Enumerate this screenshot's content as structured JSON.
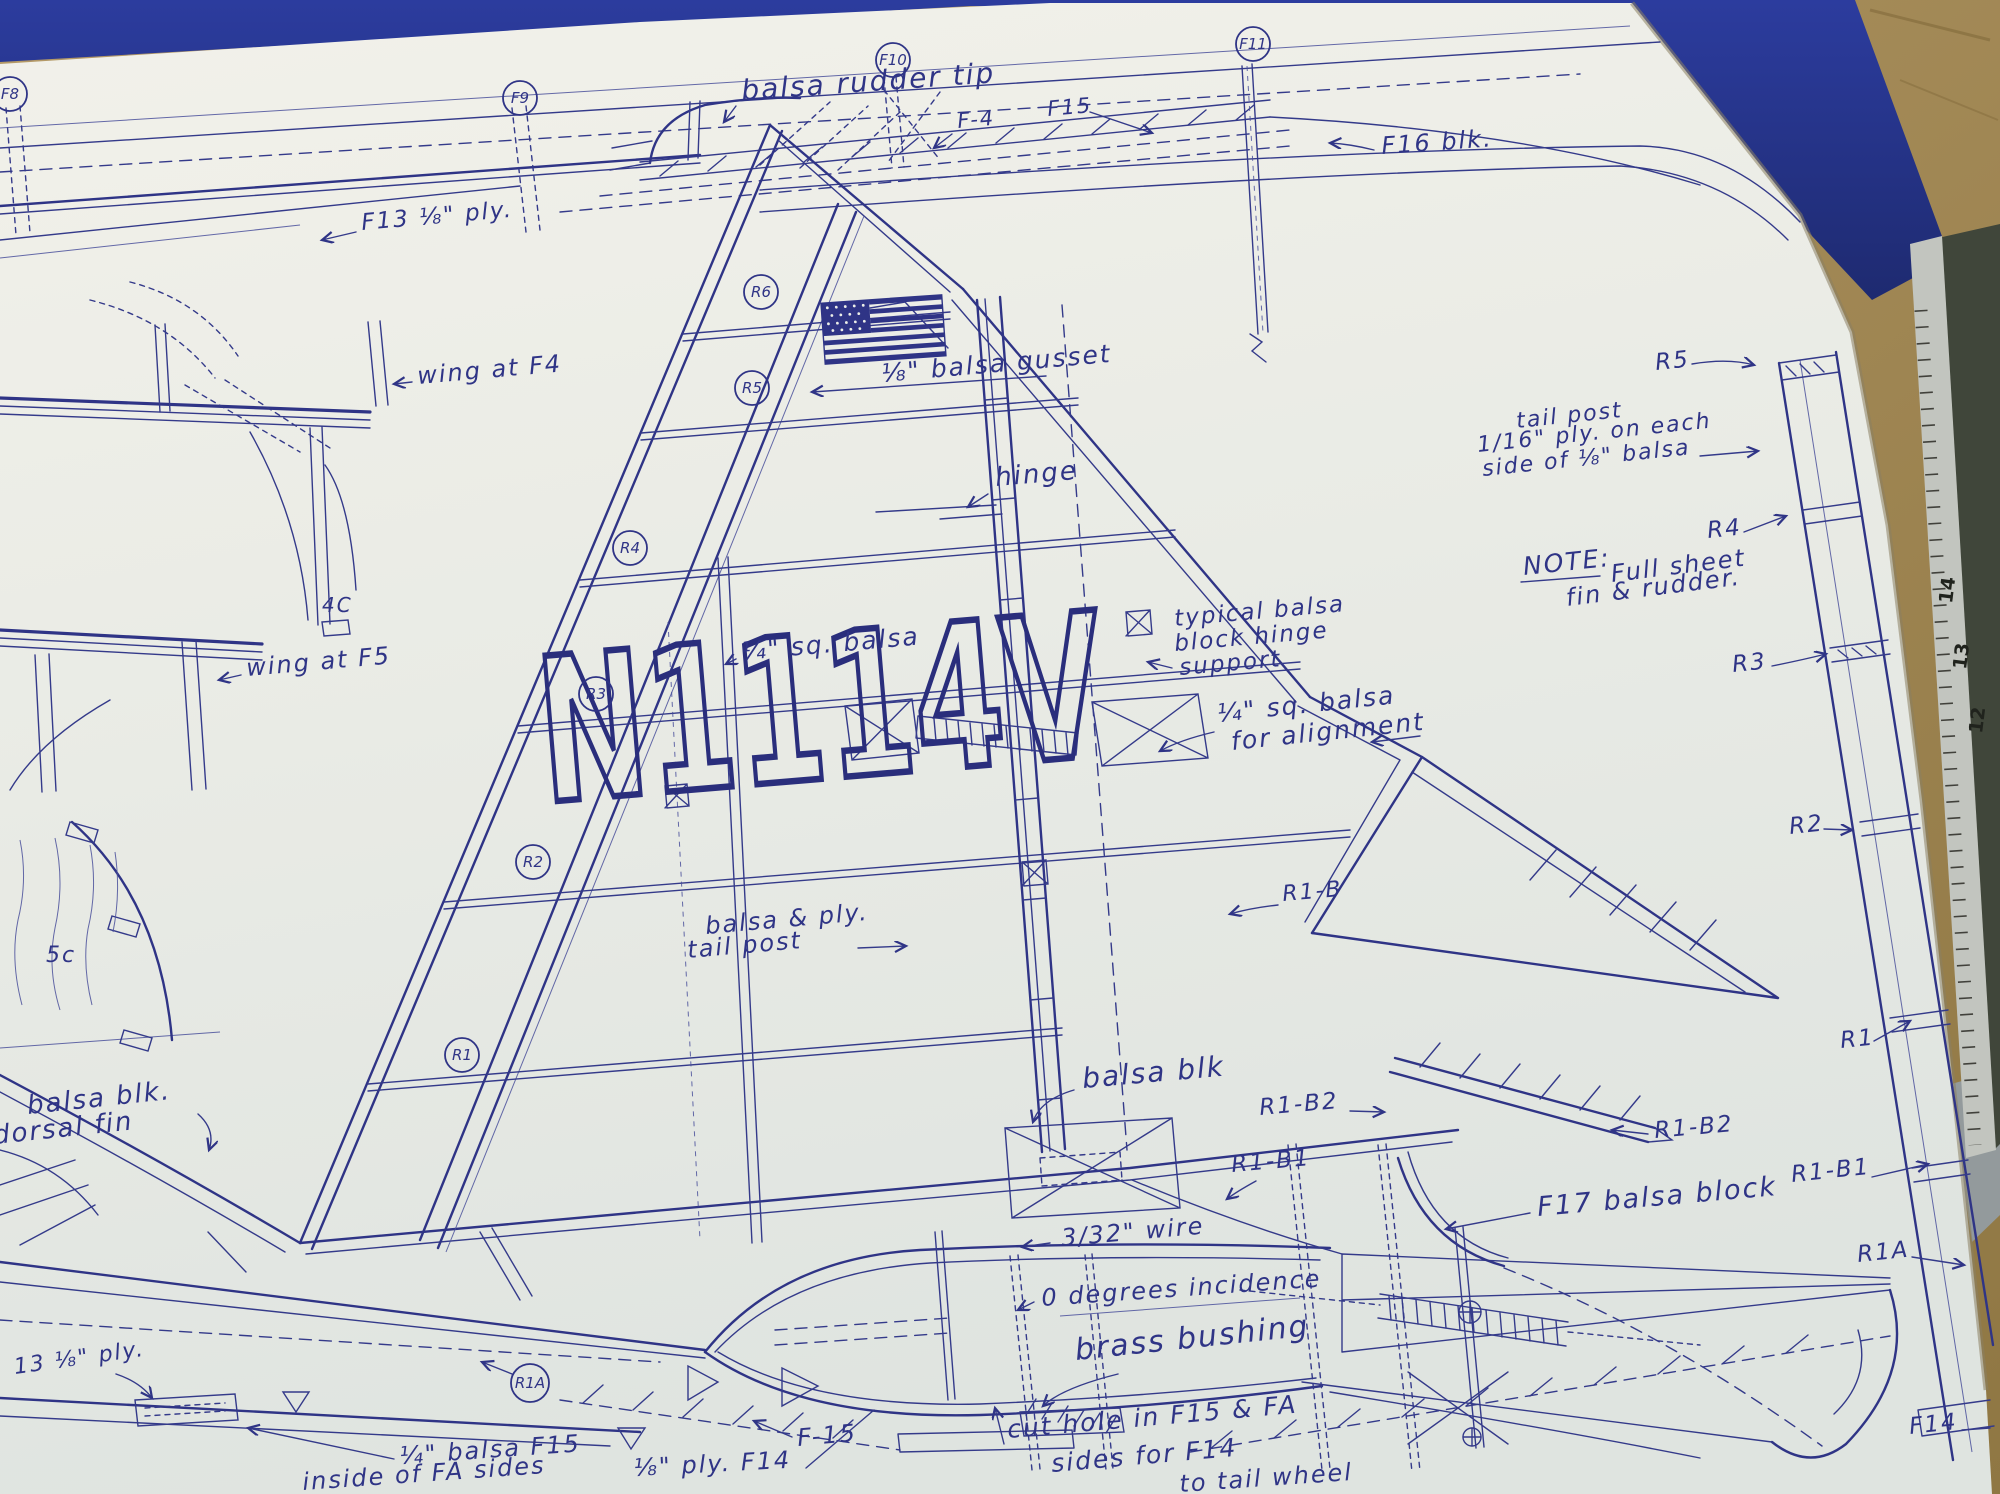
{
  "registration": "N1114V",
  "labels": {
    "balsa_rudder_tip": "balsa rudder tip",
    "f4": "F-4",
    "f15_top": "F15",
    "f16_blk": "F16 blk.",
    "f13_ply": "F13 ⅛\" ply.",
    "wing_at_f4": "wing at F4",
    "wing_at_f5": "wing at F5",
    "four_c": "4C",
    "five_c": "5c",
    "balsa_gusset": "⅛\" balsa gusset",
    "hinge": "hinge",
    "sq_balsa": "¼\" sq. balsa",
    "typical_1": "typical balsa",
    "typical_2": "block hinge",
    "typical_3": "support",
    "align_1": "¼\" sq. balsa",
    "align_2": "for alignment",
    "tailpost_note_1": "tail post",
    "tailpost_note_2": "1/16\" ply. on each",
    "tailpost_note_3": "side of ⅛\" balsa",
    "note_label": "NOTE:",
    "note_1": "Full sheet",
    "note_2": "fin & rudder.",
    "r5": "R5",
    "r4": "R4",
    "r3": "R3",
    "r2": "R2",
    "r1": "R1",
    "r1b1_right": "R1-B1",
    "r1a_right": "R1A",
    "f14": "F14",
    "r1b": "R1-B",
    "r1b2_left": "R1-B2",
    "r1b1_left": "R1-B1",
    "r1b2_right": "R1-B2",
    "balsa_ply_1": "balsa & ply.",
    "balsa_ply_2": "tail post",
    "balsa_blk": "balsa blk",
    "wire": "3/32\" wire",
    "incidence": "0 degrees incidence",
    "brass_bushing": "brass bushing",
    "f15_label": "F-15",
    "f17": "F17 balsa block",
    "cut_hole_1": "cut hole in F15 & FA",
    "cut_hole_2": "sides for F14",
    "ply_f14": "⅛\" ply. F14",
    "to_tail_wheel": "to tail wheel",
    "inside_1": "¼\" balsa F15",
    "inside_2": "inside of FA sides",
    "thirteen_ply": "13 ⅛\" ply.",
    "dorsal_1": "balsa blk.",
    "dorsal_2": "dorsal fin"
  },
  "frame_circles": {
    "f8": "F8",
    "f9": "F9",
    "f10": "F10",
    "f11": "F11"
  },
  "rib_circles": {
    "r6": "R6",
    "r5": "R5",
    "r4": "R4",
    "r3": "R3",
    "r2": "R2",
    "r1": "R1",
    "r1a": "R1A"
  },
  "ruler": {
    "markings": [
      "14",
      "13",
      "12"
    ]
  },
  "colors": {
    "ink": "#2f3486",
    "paper": "#edeee8",
    "mat_blue": "#26348e",
    "wood": "#a88d5c",
    "ruler_body": "#40463a"
  }
}
